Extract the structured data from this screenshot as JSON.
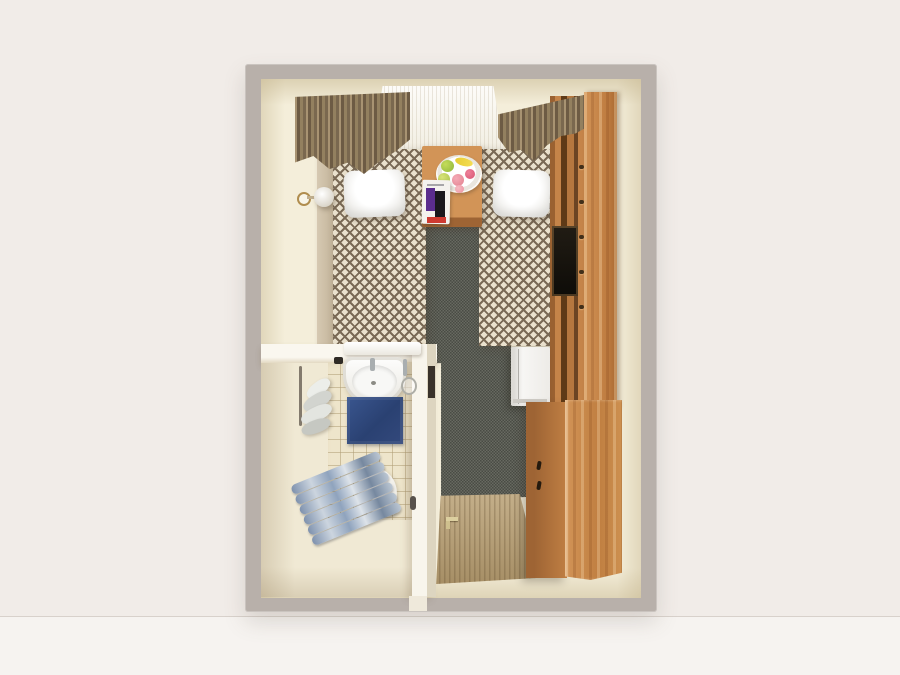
{
  "scene": {
    "type": "3d-top-down-room-render",
    "rooms": {
      "bedroom": {
        "window": [
          "sheer-curtain",
          "window-sill",
          "drape-left",
          "drape-right"
        ],
        "furniture": [
          "bed-left",
          "bed-left-pillow",
          "bed-left-rail",
          "bed-right",
          "bed-right-pillow",
          "nightstand",
          "fruit-plate",
          "magazine",
          "wall-sconce",
          "carpet",
          "wardrobe-shelf-column",
          "tv-screen",
          "wardrobe-tall-panel",
          "mini-fridge",
          "dresser",
          "entry-door"
        ]
      },
      "bathroom": {
        "fixtures": [
          "sink",
          "sink-basin",
          "faucet",
          "vanity-ledge",
          "magnifying-mirror",
          "bath-mat",
          "hand-towels",
          "towel-radiator",
          "bath-towel-stack",
          "tiled-floor",
          "partition-wall-top",
          "partition-wall-side",
          "wall-niche"
        ]
      }
    },
    "props": {
      "fruit_plate_items": [
        "green-apple",
        "banana",
        "lime",
        "peach",
        "rose-fruit",
        "blush-fruit"
      ],
      "magazine_blocks": [
        "purple-block",
        "black-block",
        "red-strip"
      ]
    }
  },
  "palette": {
    "bg": "#f1ece8",
    "bg-lower": "#f6f3f0",
    "wall-outer": "#b8b0aa",
    "wall-inner": "#f4eeda",
    "floor-bath": "#f0e9d4",
    "tile": "#eee5cb",
    "carpet": "#555850",
    "bed-base": "#eae1cd",
    "bed-brown": "#7a6a56",
    "pillow": "#ffffff",
    "sheer": "#fdfcf9",
    "drape-light": "#a89372",
    "drape-dark": "#6d5b44",
    "wood-light": "#d29457",
    "wood-mid": "#c58449",
    "wood-dark": "#9e6434",
    "door-wood": "#b59c70",
    "tv": "#211c14",
    "fridge": "#f7f6f4",
    "sink": "#fefefd",
    "chrome": "#a9aeb0",
    "mat-blue": "#3a568f",
    "towel-blue": "#7e91ad",
    "towel-gray": "#eceeea",
    "plate": "#ffffff",
    "fruit-green": "#c4dc5a",
    "fruit-lime": "#d8e378",
    "fruit-yellow": "#e8cc35",
    "fruit-pink": "#f4aab6",
    "fruit-rose": "#ee8099",
    "book-purple": "#5b2d8e",
    "book-black": "#1a181d",
    "book-red": "#cf3a31",
    "brass": "#b08d4e",
    "niche": "#39322a"
  }
}
